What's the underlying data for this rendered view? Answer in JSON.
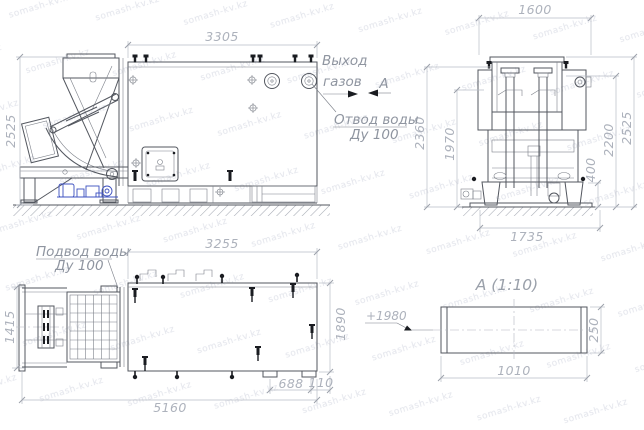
{
  "watermark": {
    "text": "somash-kv.kz"
  },
  "annotations": {
    "gas_outlet_line1": "Выход",
    "gas_outlet_line2": "газов",
    "section_arrow_label": "А",
    "water_drain_line1": "Отвод воды",
    "water_drain_line2": "Ду 100",
    "water_supply_line1": "Подвод воды",
    "water_supply_line2": "Ду 100",
    "section_offset": "+1980"
  },
  "side_view": {
    "dim_width": "3305",
    "dim_height": "2525"
  },
  "front_view": {
    "dim_top_width": "1600",
    "dim_left_outer": "2360",
    "dim_left_inner": "1970",
    "dim_right_lower": "400",
    "dim_right_mid": "2200",
    "dim_right_outer": "2525",
    "dim_base_width": "1735"
  },
  "plan_view": {
    "dim_top_width": "3255",
    "dim_left": "1415",
    "dim_right": "1890",
    "dim_total_length": "5160",
    "dim_offset": "688",
    "dim_edge": "110"
  },
  "section_view": {
    "title": "А  (1:10)",
    "dim_width": "1010",
    "dim_height": "250"
  }
}
